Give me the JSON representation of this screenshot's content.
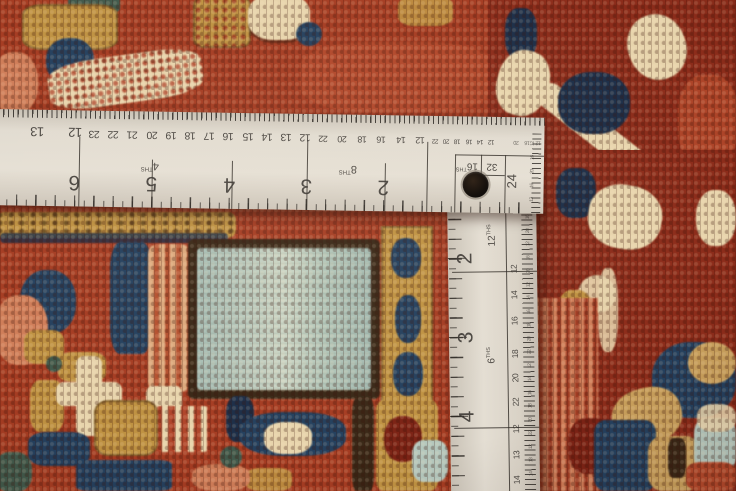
{
  "ruler": {
    "h_scale1": {
      "numbers": [
        "13",
        "12"
      ]
    },
    "h_scale2": {
      "label": "4",
      "unit": "THS",
      "numbers": [
        "23",
        "22",
        "21",
        "20",
        "19",
        "18",
        "17",
        "16",
        "15",
        "14",
        "13",
        "12"
      ]
    },
    "h_scale3": {
      "label": "8",
      "unit": "THS",
      "numbers": [
        "22",
        "20",
        "18",
        "16",
        "14",
        "12"
      ]
    },
    "h_scale4": {
      "label": "16",
      "unit": "THS",
      "numbers": [
        "22",
        "20",
        "18",
        "16",
        "14",
        "12"
      ]
    },
    "h_scale5": {
      "label": "32",
      "numbers": [
        "20",
        "16",
        "12"
      ]
    },
    "h_inches": [
      "6",
      "5",
      "4",
      "3",
      "2"
    ],
    "corner_inch": "24",
    "corner_edge_numbers": [
      "12",
      "16",
      "20",
      "16",
      "12"
    ],
    "v_inches": [
      "2",
      "3",
      "4"
    ],
    "v_scaleA": {
      "label": "12",
      "unit": "THS",
      "numbers": [
        "12",
        "14",
        "16"
      ]
    },
    "v_scaleB": {
      "label": "6",
      "unit": "THS",
      "numbers": [
        "18",
        "20",
        "22"
      ]
    },
    "v_scaleC": {
      "numbers": [
        "12",
        "13",
        "14"
      ]
    },
    "v_fine": [
      "16",
      "20",
      "12",
      "16",
      "20",
      "12",
      "14",
      "16",
      "18",
      "20",
      "22",
      "12",
      "14",
      "16",
      "18",
      "20",
      "22",
      "12",
      "13",
      "14"
    ]
  },
  "palette": {
    "red_field": "#a53c22",
    "red_bright": "#b3492b",
    "red_dark": "#8c2c1a",
    "red_deep": "#7c2315",
    "gold": "#bf9242",
    "tan": "#c9a05c",
    "navy": "#24405e",
    "navy_dark": "#1c2e48",
    "cream": "#e7d4ac",
    "peach": "#dca87c",
    "salmon": "#cf7d58",
    "light_blue": "#b4c7bd",
    "teal": "#41594b",
    "brown_dark": "#3a2817",
    "ruler_face": "#ded7cc",
    "ink": "#3b3733"
  }
}
